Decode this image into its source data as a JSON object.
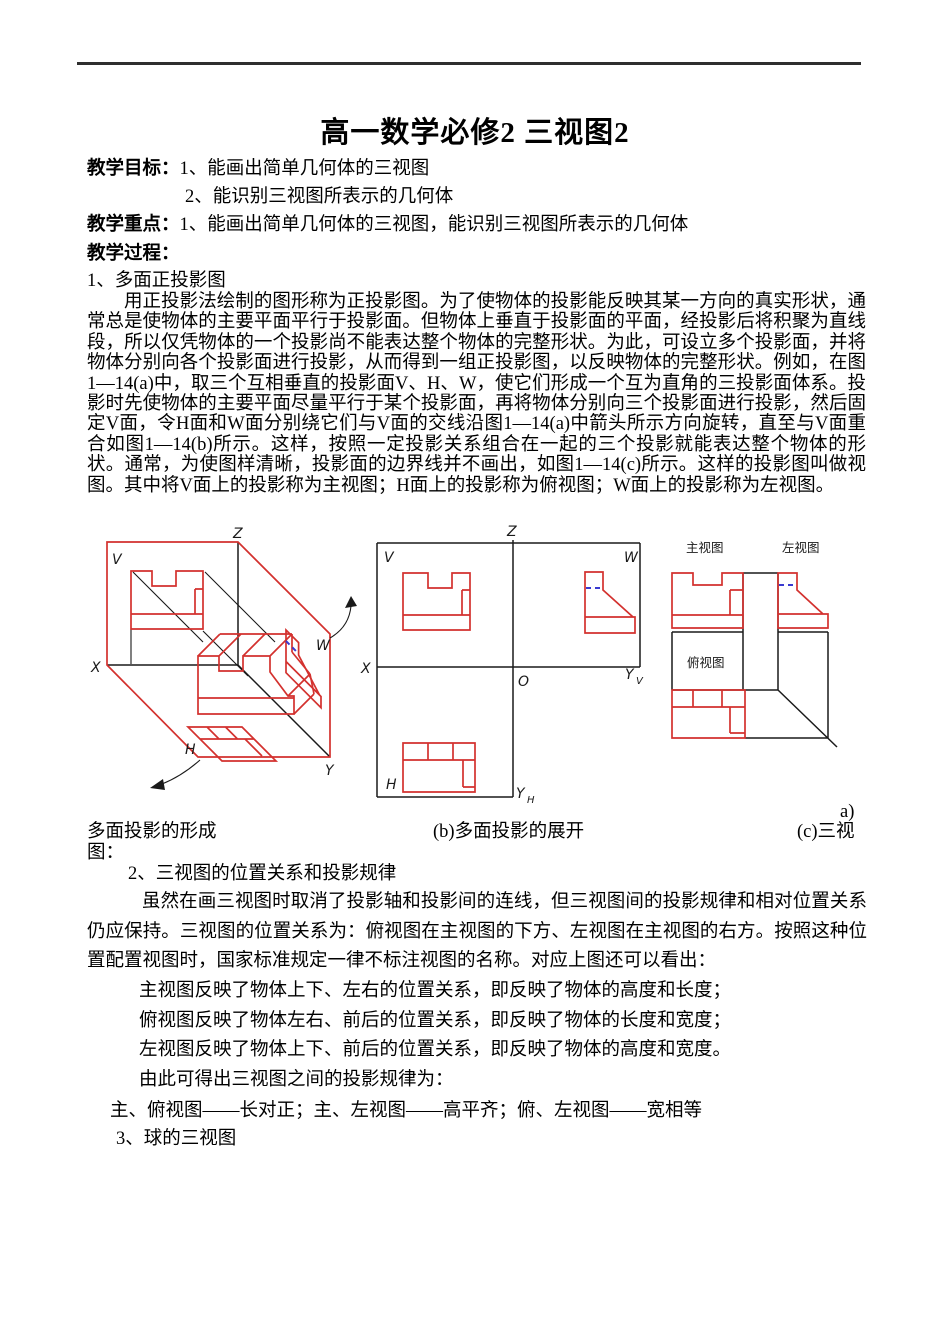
{
  "colors": {
    "figure_red": "#d3312e",
    "figure_blue": "#3a3ad0",
    "line_black": "#1a1a1a"
  },
  "doc": {
    "title": "高一数学必修2 三视图2",
    "objectives_label": "教学目标：",
    "objectives": [
      "1、能画出简单几何体的三视图",
      "2、能识别三视图所表示的几何体"
    ],
    "focus_label": "教学重点：",
    "focus_text": "1、能画出简单几何体的三视图，能识别三视图所表示的几何体",
    "process_label": "教学过程：",
    "item1_heading": "1、多面正投影图",
    "para1": "用正投影法绘制的图形称为正投影图。为了使物体的投影能反映其某一方向的真实形状，通常总是使物体的主要平面平行于投影面。但物体上垂直于投影面的平面，经投影后将积聚为直线段，所以仅凭物体的一个投影尚不能表达整个物体的完整形状。为此，可设立多个投影面，并将物体分别向各个投影面进行投影，从而得到一组正投影图，以反映物体的完整形状。例如，在图1—14(a)中，取三个互相垂直的投影面V、H、W，使它们形成一个互为直角的三投影面体系。投影时先使物体的主要平面尽量平行于某个投影面，再将物体分别向三个投影面进行投影，然后固定V面，令H面和W面分别绕它们与V面的交线沿图1—14(a)中箭头所示方向旋转，直至与V面重合如图1—14(b)所示。这样，按照一定投影关系组合在一起的三个投影就能表达整个物体的形状。通常，为使图样清晰，投影面的边界线并不画出，如图1—14(c)所示。这样的投影图叫做视图。其中将V面上的投影称为主视图；H面上的投影称为俯视图；W面上的投影称为左视图。",
    "caption_overflow": "a)",
    "caption_a": "多面投影的形成",
    "caption_b": "(b)多面投影的展开",
    "caption_c": "(c)三视",
    "caption_wrap": "图：",
    "item2_heading": "2、三视图的位置关系和投影规律",
    "para2": "虽然在画三视图时取消了投影轴和投影间的连线，但三视图间的投影规律和相对位置关系仍应保持。三视图的位置关系为：俯视图在主视图的下方、左视图在主视图的右方。按照这种位置配置视图时，国家标准规定一律不标注视图的名称。对应上图还可以看出：",
    "view_rules": [
      "主视图反映了物体上下、左右的位置关系，即反映了物体的高度和长度；",
      "俯视图反映了物体左右、前后的位置关系，即反映了物体的长度和宽度；",
      "左视图反映了物体上下、前后的位置关系，即反映了物体的高度和宽度。",
      "由此可得出三视图之间的投影规律为："
    ],
    "projection_law": "主、俯视图——长对正；主、左视图——高平齐；俯、左视图——宽相等",
    "item3_heading": "3、球的三视图"
  },
  "figures": {
    "a": {
      "labels": {
        "z": "Z",
        "v": "V",
        "w": "W",
        "x": "X",
        "y": "Y",
        "h": "H"
      }
    },
    "b": {
      "labels": {
        "z": "Z",
        "v": "V",
        "w": "W",
        "x": "X",
        "o": "O",
        "y_right": "Y",
        "y_right_sub": "V",
        "h": "H",
        "y_bottom": "Y",
        "y_bottom_sub": "H"
      }
    },
    "c": {
      "labels": {
        "front": "主视图",
        "side": "左视图",
        "top": "俯视图"
      }
    }
  }
}
